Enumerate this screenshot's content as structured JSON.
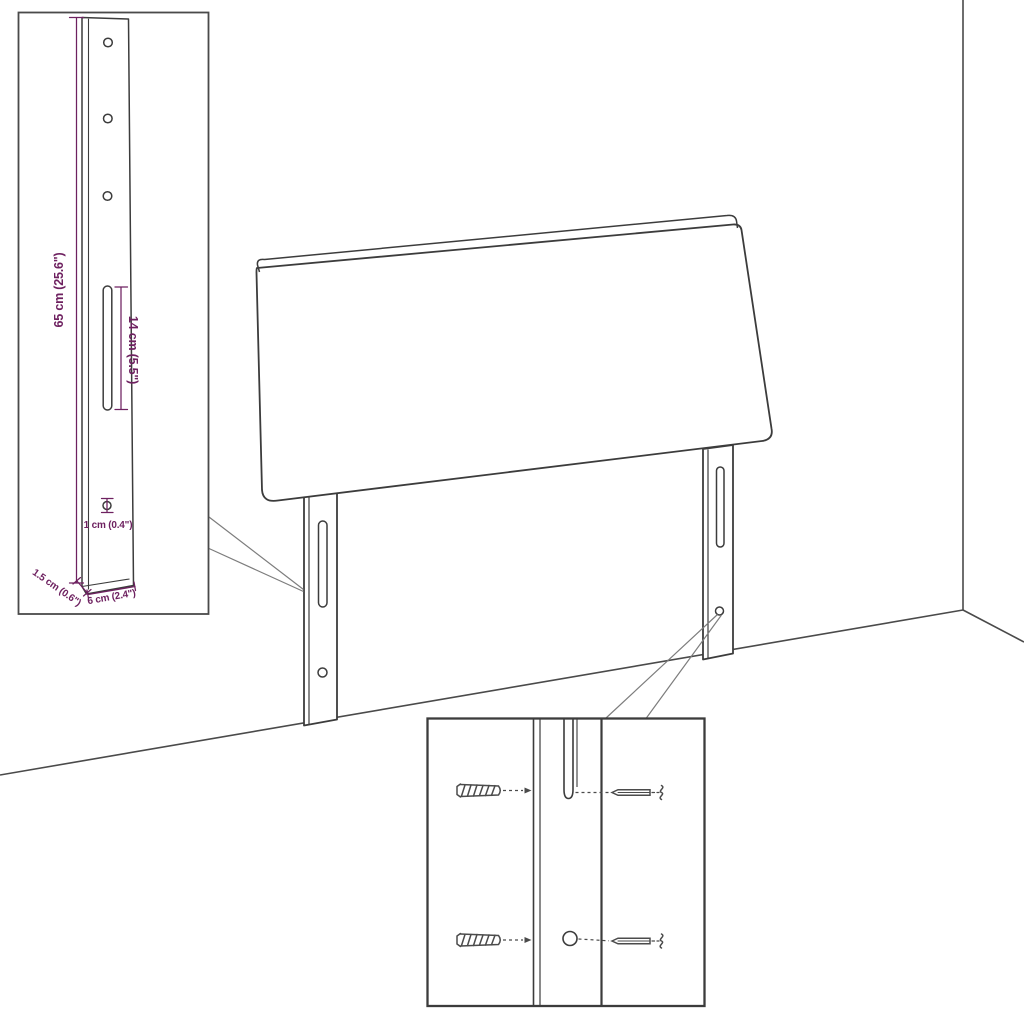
{
  "colors": {
    "background": "#ffffff",
    "line": "#3c3c3c",
    "box_border": "#4a4a4a",
    "callout": "#7d7d7d",
    "hardware": "#4b4b4b",
    "dimension": "#6e2160"
  },
  "inset_dimensions": {
    "height": "65 cm (25.6\")",
    "slot_length": "14 cm (5.5\")",
    "hole_diameter": "1 cm (0.4\")",
    "thickness": "1.5 cm (0.6\")",
    "width": "6 cm (2.4\")"
  }
}
